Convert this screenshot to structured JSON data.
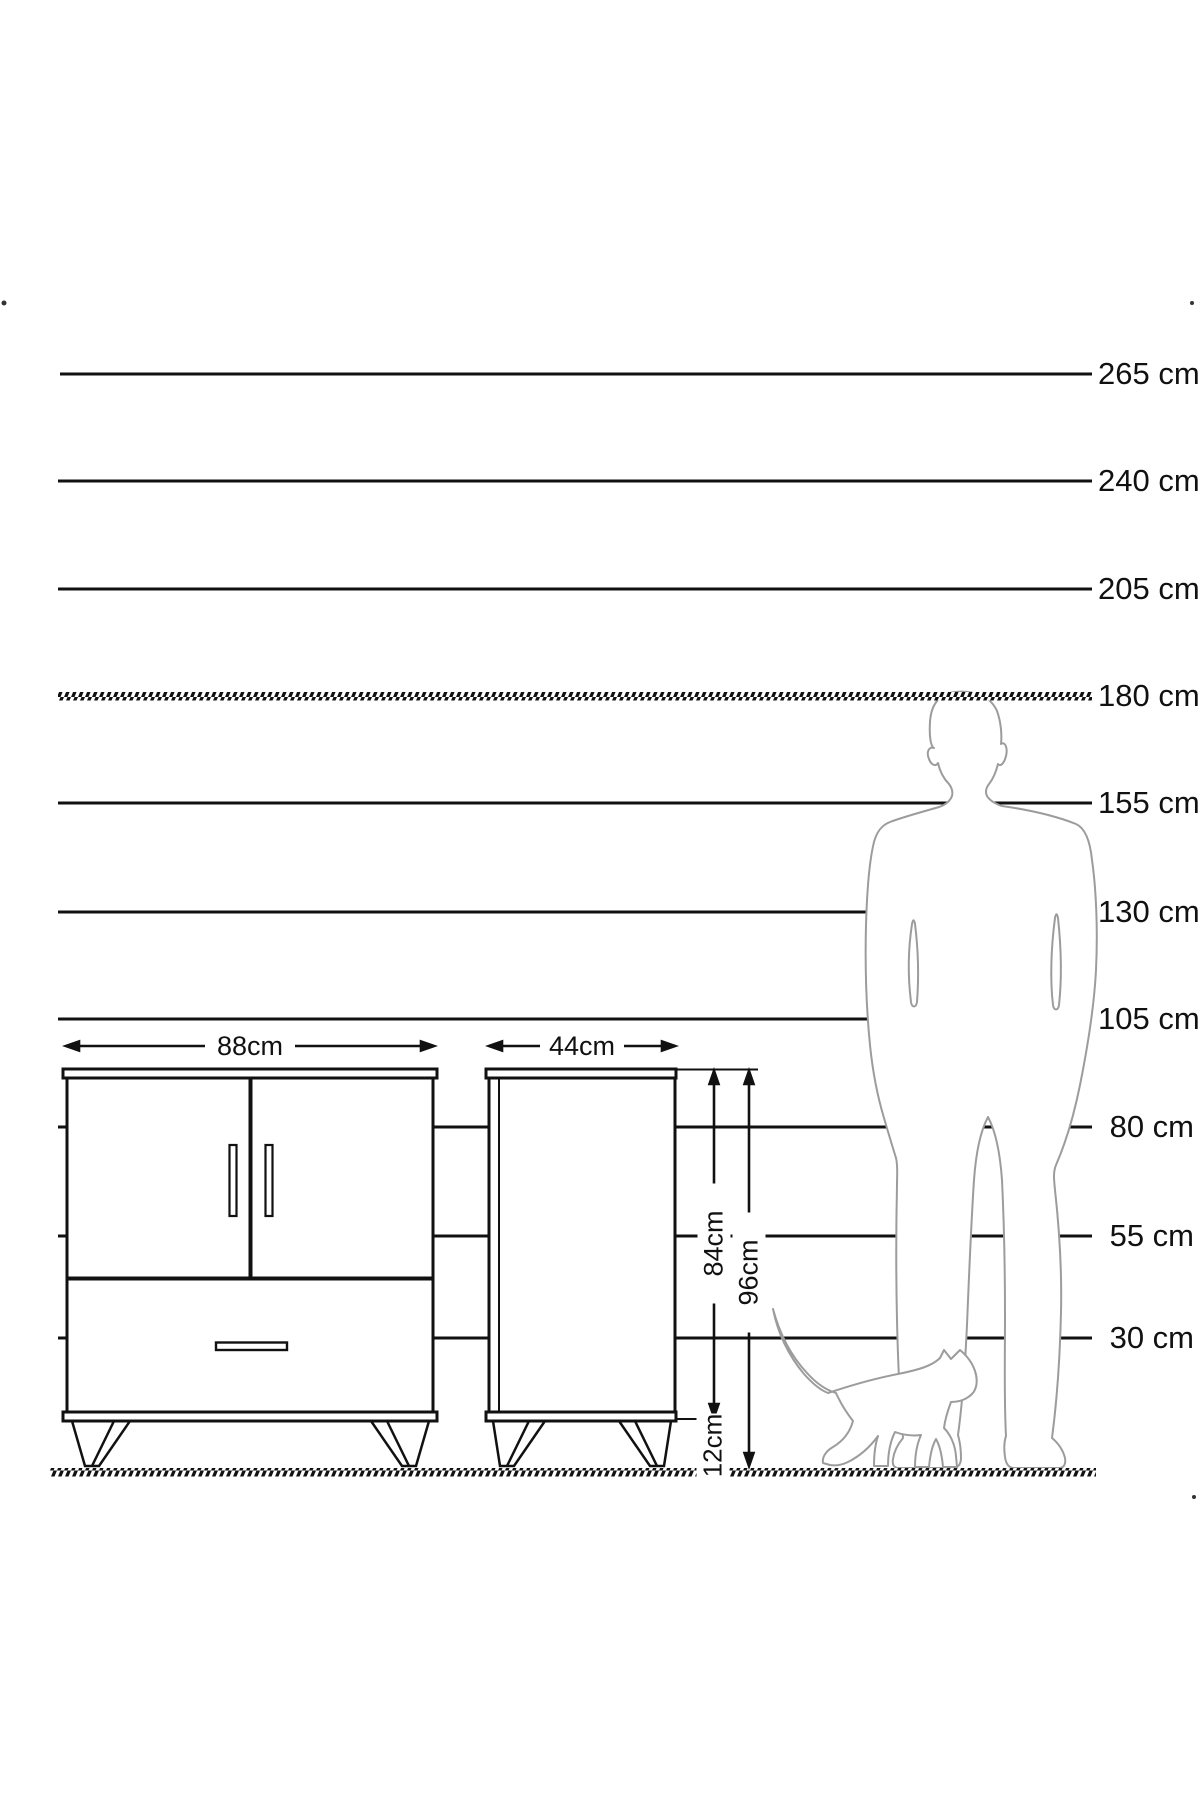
{
  "diagram": {
    "scale_lines": [
      {
        "label": "265 cm",
        "y": 374,
        "style": "solid"
      },
      {
        "label": "240 cm",
        "y": 481,
        "style": "solid"
      },
      {
        "label": "205 cm",
        "y": 589,
        "style": "solid"
      },
      {
        "label": "180 cm",
        "y": 696,
        "style": "hatched"
      },
      {
        "label": "155 cm",
        "y": 803,
        "style": "solid"
      },
      {
        "label": "130 cm",
        "y": 912,
        "style": "solid"
      },
      {
        "label": "105 cm",
        "y": 1019,
        "style": "solid"
      },
      {
        "label": "80 cm",
        "y": 1127,
        "style": "solid"
      },
      {
        "label": "55 cm",
        "y": 1236,
        "style": "solid"
      },
      {
        "label": "30 cm",
        "y": 1338,
        "style": "solid"
      }
    ],
    "ground_line": {
      "y": 1472,
      "style": "hatched"
    },
    "dimensions": {
      "front_width": "88cm",
      "side_width": "44cm",
      "body_height": "84cm",
      "total_height": "96cm",
      "leg_height": "12cm"
    },
    "figures": {
      "man": "man-silhouette-180cm-reference",
      "cat": "cat-silhouette-reference"
    },
    "colors": {
      "ink": "#111111",
      "silhouette": "#9c9c9c",
      "background": "#ffffff"
    }
  }
}
